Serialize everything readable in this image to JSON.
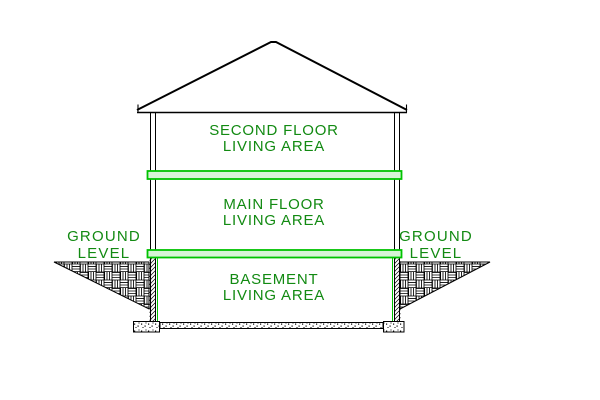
{
  "title": "House cross-section diagram",
  "colors": {
    "label_green": "#128a12",
    "band_green": "#00c300",
    "band_fill": "#d8f4d8",
    "line_black": "#000000",
    "background": "#ffffff"
  },
  "labels": {
    "second_floor": {
      "line1": "SECOND FLOOR",
      "line2": "LIVING AREA"
    },
    "main_floor": {
      "line1": "MAIN FLOOR",
      "line2": "LIVING AREA"
    },
    "basement": {
      "line1": "BASEMENT",
      "line2": "LIVING AREA"
    },
    "ground_left": {
      "line1": "GROUND",
      "line2": "LEVEL"
    },
    "ground_right": {
      "line1": "GROUND",
      "line2": "LEVEL"
    }
  }
}
